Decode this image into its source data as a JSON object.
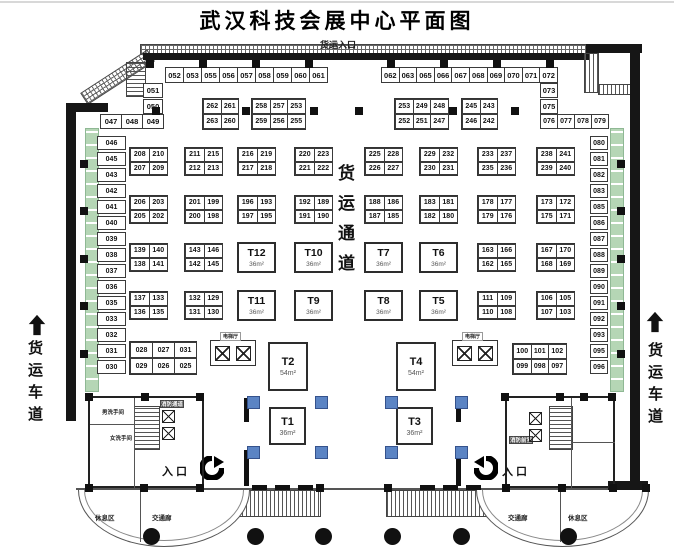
{
  "title": "武汉科技会展中心平面图",
  "labels": {
    "freight_entrance": "货运入口",
    "freight_lane": "货运车道",
    "central_aisle": "货运通道",
    "entrance": "入口",
    "rest_area": "休息区",
    "corridor": "交通廊",
    "mens_restroom": "男洗手间",
    "womens_restroom": "女洗手间",
    "fire_passage": "消防通道",
    "fire_anteroom": "消防前室",
    "elevator_hall": "电梯厅"
  },
  "colors": {
    "green_strip": "#b5d6b5",
    "blue_column": "#5b84c4",
    "wall": "#161616"
  },
  "booths": {
    "top_row_left": [
      "052",
      "053",
      "055",
      "056",
      "057",
      "058",
      "059",
      "060",
      "061"
    ],
    "top_row_right": [
      "062",
      "063",
      "065",
      "066",
      "067",
      "068",
      "069",
      "070",
      "071",
      "072"
    ],
    "left_step_stack": [
      "051",
      "050"
    ],
    "left_step_row": [
      "047",
      "048",
      "049"
    ],
    "right_step_stack": [
      "073",
      "075"
    ],
    "right_step_row": [
      "076",
      "077",
      "078",
      "079"
    ],
    "left_column": [
      "046",
      "045",
      "043",
      "042",
      "041",
      "040",
      "039",
      "038",
      "037",
      "036",
      "035",
      "033",
      "032",
      "031",
      "030"
    ],
    "right_column": [
      "080",
      "081",
      "082",
      "083",
      "085",
      "086",
      "087",
      "088",
      "089",
      "090",
      "091",
      "092",
      "093",
      "095",
      "096"
    ],
    "top_islands": [
      [
        [
          "262",
          "261"
        ],
        [
          "263",
          "260"
        ]
      ],
      [
        [
          "258",
          "257",
          "253"
        ],
        [
          "259",
          "256",
          "255"
        ]
      ],
      [
        [
          "253",
          "249",
          "248"
        ],
        [
          "252",
          "251",
          "247"
        ]
      ],
      [
        [
          "245",
          "243"
        ],
        [
          "246",
          "242"
        ]
      ]
    ],
    "hall_grid": [
      {
        "type": "island",
        "cells": [
          [
            "208",
            "210"
          ],
          [
            "207",
            "209"
          ]
        ]
      },
      {
        "type": "island",
        "cells": [
          [
            "211",
            "215"
          ],
          [
            "212",
            "213"
          ]
        ]
      },
      {
        "type": "island",
        "cells": [
          [
            "216",
            "219"
          ],
          [
            "217",
            "218"
          ]
        ]
      },
      {
        "type": "island",
        "cells": [
          [
            "220",
            "223"
          ],
          [
            "221",
            "222"
          ]
        ]
      },
      {
        "type": "island",
        "cells": [
          [
            "225",
            "228"
          ],
          [
            "226",
            "227"
          ]
        ]
      },
      {
        "type": "island",
        "cells": [
          [
            "229",
            "232"
          ],
          [
            "230",
            "231"
          ]
        ]
      },
      {
        "type": "island",
        "cells": [
          [
            "233",
            "237"
          ],
          [
            "235",
            "236"
          ]
        ]
      },
      {
        "type": "island",
        "cells": [
          [
            "238",
            "241"
          ],
          [
            "239",
            "240"
          ]
        ]
      },
      {
        "type": "island",
        "cells": [
          [
            "206",
            "203"
          ],
          [
            "205",
            "202"
          ]
        ]
      },
      {
        "type": "island",
        "cells": [
          [
            "201",
            "199"
          ],
          [
            "200",
            "198"
          ]
        ]
      },
      {
        "type": "island",
        "cells": [
          [
            "196",
            "193"
          ],
          [
            "197",
            "195"
          ]
        ]
      },
      {
        "type": "island",
        "cells": [
          [
            "192",
            "189"
          ],
          [
            "191",
            "190"
          ]
        ]
      },
      {
        "type": "island",
        "cells": [
          [
            "188",
            "186"
          ],
          [
            "187",
            "185"
          ]
        ]
      },
      {
        "type": "island",
        "cells": [
          [
            "183",
            "181"
          ],
          [
            "182",
            "180"
          ]
        ]
      },
      {
        "type": "island",
        "cells": [
          [
            "178",
            "177"
          ],
          [
            "179",
            "176"
          ]
        ]
      },
      {
        "type": "island",
        "cells": [
          [
            "173",
            "172"
          ],
          [
            "175",
            "171"
          ]
        ]
      },
      {
        "type": "island",
        "cells": [
          [
            "139",
            "140"
          ],
          [
            "138",
            "141"
          ]
        ]
      },
      {
        "type": "island",
        "cells": [
          [
            "143",
            "146"
          ],
          [
            "142",
            "145"
          ]
        ]
      },
      {
        "type": "t",
        "name": "T12",
        "size": "36m²"
      },
      {
        "type": "t",
        "name": "T10",
        "size": "36m²"
      },
      {
        "type": "t",
        "name": "T7",
        "size": "36m²"
      },
      {
        "type": "t",
        "name": "T6",
        "size": "36m²"
      },
      {
        "type": "island",
        "cells": [
          [
            "163",
            "166"
          ],
          [
            "162",
            "165"
          ]
        ]
      },
      {
        "type": "island",
        "cells": [
          [
            "167",
            "170"
          ],
          [
            "168",
            "169"
          ]
        ]
      },
      {
        "type": "island",
        "cells": [
          [
            "137",
            "133"
          ],
          [
            "136",
            "135"
          ]
        ]
      },
      {
        "type": "island",
        "cells": [
          [
            "132",
            "129"
          ],
          [
            "131",
            "130"
          ]
        ]
      },
      {
        "type": "t",
        "name": "T11",
        "size": "36m²"
      },
      {
        "type": "t",
        "name": "T9",
        "size": "36m²"
      },
      {
        "type": "t",
        "name": "T8",
        "size": "36m²"
      },
      {
        "type": "t",
        "name": "T5",
        "size": "36m²"
      },
      {
        "type": "island",
        "cells": [
          [
            "111",
            "109"
          ],
          [
            "110",
            "108"
          ]
        ]
      },
      {
        "type": "island",
        "cells": [
          [
            "106",
            "105"
          ],
          [
            "107",
            "103"
          ]
        ]
      }
    ],
    "bottom_left_block": [
      [
        "028",
        "027",
        "031"
      ],
      [
        "029",
        "026",
        "025"
      ]
    ],
    "bottom_right_block": [
      [
        "100",
        "101",
        "102"
      ],
      [
        "099",
        "098",
        "097"
      ]
    ]
  },
  "t_booths_center": [
    {
      "name": "T2",
      "size": "54m²"
    },
    {
      "name": "T4",
      "size": "54m²"
    },
    {
      "name": "T1",
      "size": "36m²"
    },
    {
      "name": "T3",
      "size": "36m²"
    }
  ]
}
